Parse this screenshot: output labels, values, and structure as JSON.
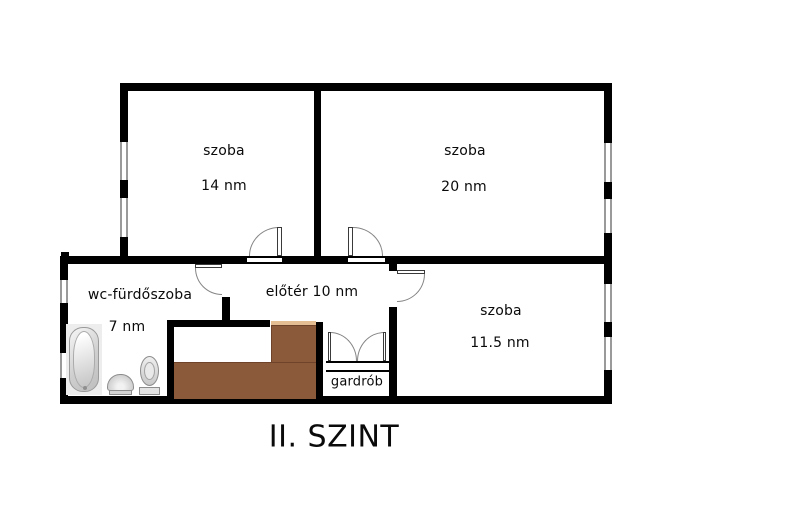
{
  "floorplan": {
    "title": "II. SZINT",
    "rooms": {
      "room14": {
        "name": "szoba",
        "area": "14 nm"
      },
      "room20": {
        "name": "szoba",
        "area": "20 nm"
      },
      "bathroom": {
        "name": "wc-fürdőszoba",
        "area": "7 nm"
      },
      "hall": {
        "label": "előtér 10 nm"
      },
      "room115": {
        "name": "szoba",
        "area": "11.5 nm"
      },
      "wardrobe": {
        "label": "gardrób"
      }
    },
    "colors": {
      "wall": "#000000",
      "stairs": "#8a5a3b",
      "stairs_edge": "#6e432a",
      "stairs_highlight": "#e6be93",
      "door_arc": "#858585",
      "window_frame": "#9a9a9a",
      "fixture_fill": "#d9d9d9",
      "fixture_panel": "#ededed"
    }
  }
}
